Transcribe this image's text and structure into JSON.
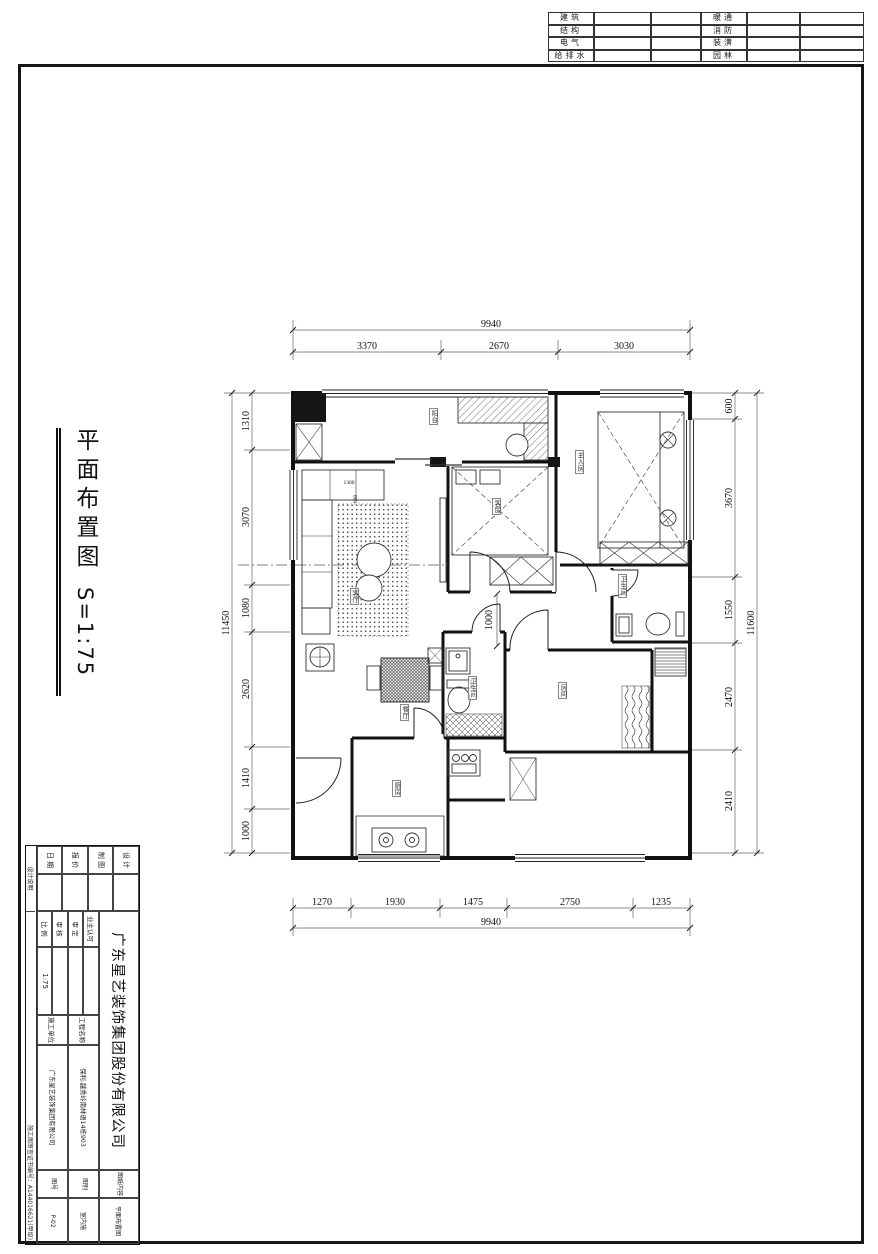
{
  "discipline_table": {
    "left_labels": [
      "建筑",
      "结构",
      "电气",
      "给排水"
    ],
    "right_labels": [
      "暖通",
      "消防",
      "装潢",
      "园林"
    ]
  },
  "side_title": {
    "title": "平面布置图",
    "scale": "S=1:75"
  },
  "plan": {
    "dims": {
      "top_overall": "9940",
      "top_segments": [
        "3370",
        "2670",
        "3030"
      ],
      "bottom_segments": [
        "1270",
        "1930",
        "1475",
        "2750",
        "1235"
      ],
      "bottom_overall": "9940",
      "left_overall": "11450",
      "left_segments": [
        "1310",
        "3070",
        "1080",
        "2620",
        "1410",
        "1000"
      ],
      "right_segments": [
        "600",
        "3670",
        "1550",
        "2470",
        "2410"
      ],
      "right_overall": "11600",
      "interior": [
        "1000",
        "1300",
        "600"
      ]
    },
    "room_labels": [
      "阳台",
      "主人房",
      "客房",
      "客厅",
      "餐厅",
      "卫生间",
      "房间",
      "厨房",
      "卫生间"
    ]
  },
  "title_block": {
    "company": "广东星艺装饰集团股份有限公司",
    "col_a": [
      "设 计",
      "制 图",
      "报 价",
      "日 期"
    ],
    "col_b_labels": [
      "业主认可",
      "审 定",
      "审 核",
      "比 例"
    ],
    "scale_value": "1:75",
    "project_label": "工程名称",
    "project_value": "保利.越秀岭南林语14栋903",
    "builder_label": "施工单位",
    "builder_value": "广东星艺装饰集团有限公司",
    "content_label": "图纸内容",
    "content_value": "平面布置图",
    "category_label": "图别",
    "category_value": "室内施",
    "number_label": "图号",
    "number_value": "P-02",
    "edge_top": "设计说明",
    "edge_bottom": "施工图审查证书编号：A144016621(甲级)"
  }
}
